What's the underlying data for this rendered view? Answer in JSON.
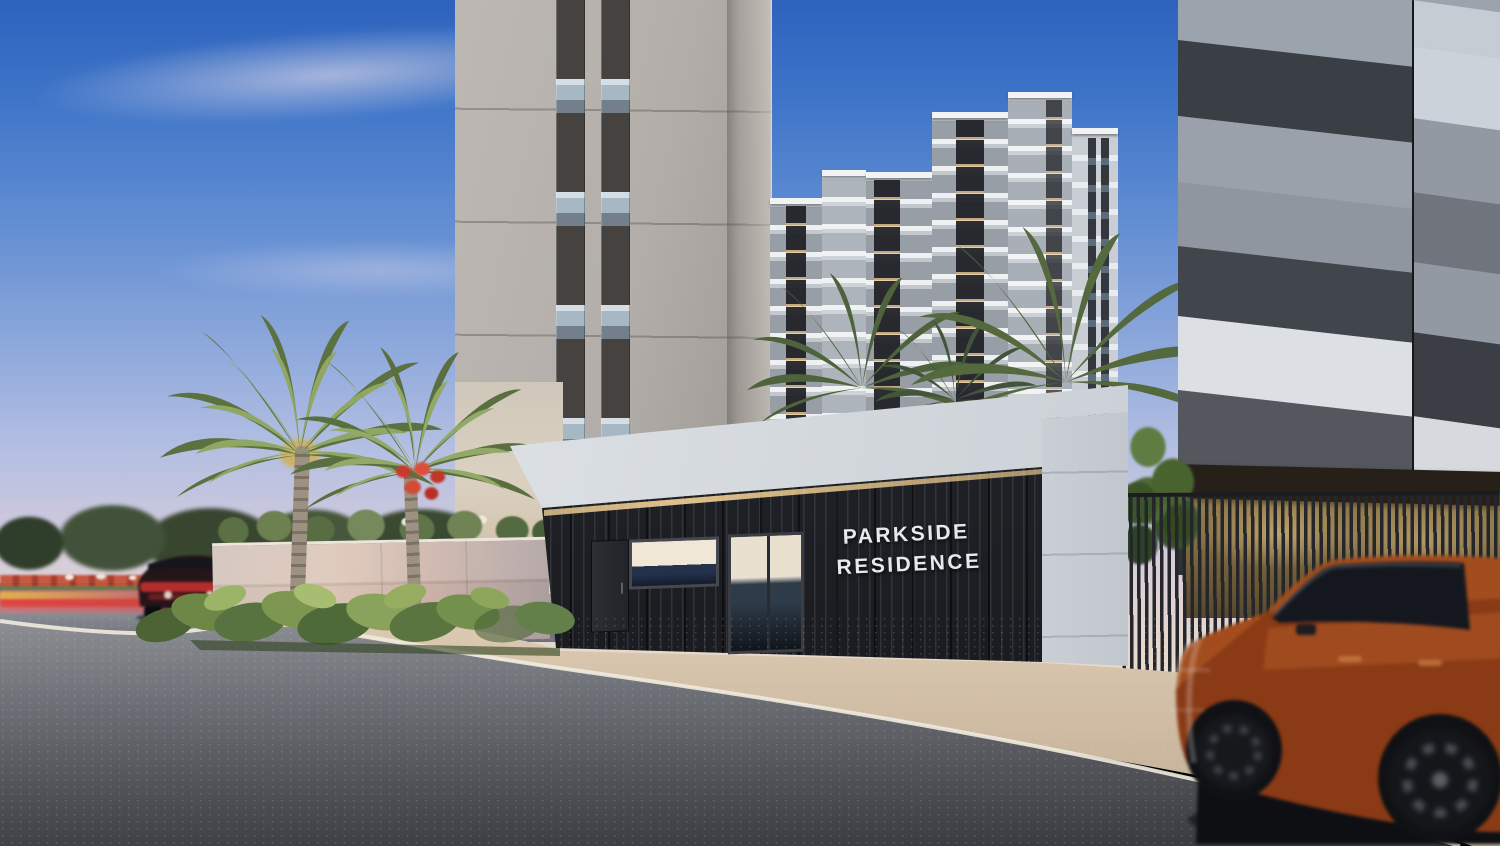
{
  "meta": {
    "description": "Dusk architectural rendering of a residential development entrance",
    "render_type": "exterior-3d-visualization"
  },
  "signage": {
    "line1": "PARKSIDE",
    "line2": "RESIDENCE"
  },
  "palette": {
    "sky_top": "#2d63bd",
    "sky_horizon": "#e7d9cb",
    "gatehouse_cladding": "#202227",
    "gatehouse_fascia": "#e3e7eb",
    "warm_led_light": "#f4d296",
    "left_tower_facade": "#b3aea9",
    "right_tower_dark_panel": "#3a3f46",
    "right_tower_light_panel": "#dcdfe4",
    "foliage_green": "#6d8150",
    "flame_tree_red": "#d34a36",
    "foreground_suv_paint": "#9c4a20",
    "asphalt": "#55575c",
    "sidewalk": "#d2c0a9",
    "bike_lane_red": "#c94343"
  }
}
